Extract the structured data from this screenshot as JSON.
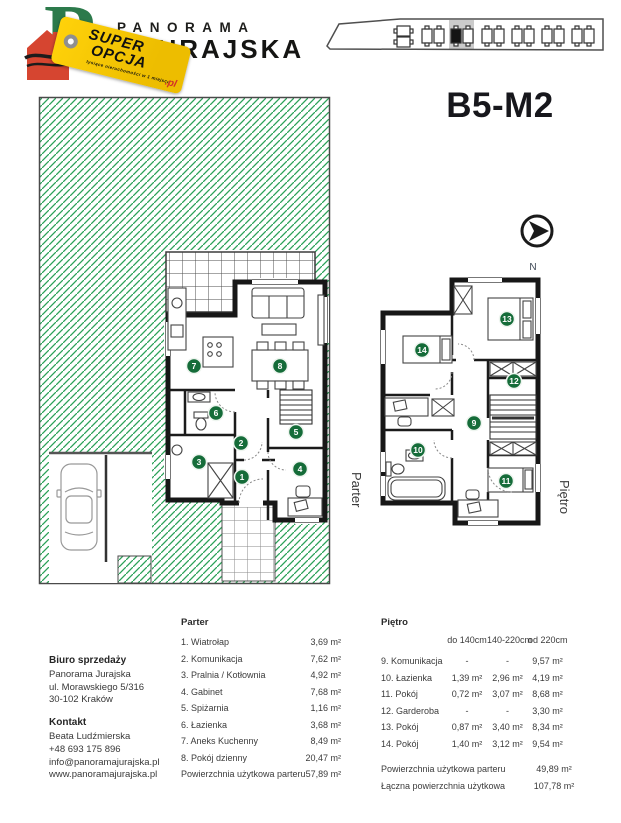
{
  "header": {
    "brand": {
      "name_top": "PANORAMA",
      "name_bottom": "JURAJSKA",
      "tag_word1": "SUPER",
      "tag_word2": "OPCJA",
      "tag_subtext": "tysiące nieruchomości w 1 miejscu",
      "tag_suffix": ".pl"
    },
    "unit_title": "B5-M2"
  },
  "plans": {
    "parter_label": "Parter",
    "pietro_label": "Piętro",
    "compass_label": "N",
    "room_numbers_parter": [
      "1",
      "2",
      "3",
      "4",
      "5",
      "6",
      "7",
      "8"
    ],
    "room_numbers_pietro": [
      "9",
      "10",
      "11",
      "12",
      "13",
      "14"
    ]
  },
  "tables": {
    "parter": {
      "title": "Parter",
      "rows": [
        {
          "label": "1. Wiatrołap",
          "area": "3,69 m²"
        },
        {
          "label": "2. Komunikacja",
          "area": "7,62 m²"
        },
        {
          "label": "3. Pralnia / Kotłownia",
          "area": "4,92 m²"
        },
        {
          "label": "4. Gabinet",
          "area": "7,68 m²"
        },
        {
          "label": "5. Spiżarnia",
          "area": "1,16 m²"
        },
        {
          "label": "6. Łazienka",
          "area": "3,68 m²"
        },
        {
          "label": "7. Aneks Kuchenny",
          "area": "8,49 m²"
        },
        {
          "label": "8. Pokój dzienny",
          "area": "20,47 m²"
        }
      ],
      "total_label": "Powierzchnia użytkowa parteru",
      "total_value": "57,89 m²"
    },
    "pietro": {
      "title": "Piętro",
      "columns": [
        "do 140cm",
        "140-220cm",
        "od 220cm"
      ],
      "rows": [
        {
          "label": "9. Komunikacja",
          "c1": "-",
          "c2": "-",
          "c3": "9,57 m²"
        },
        {
          "label": "10. Łazienka",
          "c1": "1,39 m²",
          "c2": "2,96 m²",
          "c3": "4,19 m²"
        },
        {
          "label": "11. Pokój",
          "c1": "0,72 m²",
          "c2": "3,07 m²",
          "c3": "8,68 m²"
        },
        {
          "label": "12. Garderoba",
          "c1": "-",
          "c2": "-",
          "c3": "3,30 m²"
        },
        {
          "label": "13. Pokój",
          "c1": "0,87 m²",
          "c2": "3,40 m²",
          "c3": "8,34 m²"
        },
        {
          "label": "14. Pokój",
          "c1": "1,40 m²",
          "c2": "3,12 m²",
          "c3": "9,54 m²"
        }
      ],
      "totals": [
        {
          "label": "Powierzchnia użytkowa parteru",
          "value": "49,89 m²"
        },
        {
          "label": "Łączna powierzchnia użytkowa",
          "value": "107,78 m²"
        }
      ]
    }
  },
  "contact": {
    "office_heading": "Biuro sprzedaży",
    "office_lines": [
      "Panorama Jurajska",
      "ul. Morawskiego 5/316",
      "30-102 Kraków"
    ],
    "contact_heading": "Kontakt",
    "contact_lines": [
      "Beata Ludźmierska",
      "+48 693 175 896",
      "info@panoramajurajska.pl"
    ],
    "website": "www.panoramajurajska.pl"
  },
  "colors": {
    "hatch_green": "#2aa158",
    "badge_green": "#156c39",
    "tag_yellow": "#f6c90e",
    "logo_green": "#2c7a4b",
    "house_red": "#d64530",
    "selected_unit_gray": "#cbcbcb",
    "text_dark": "#3b3b3b"
  }
}
